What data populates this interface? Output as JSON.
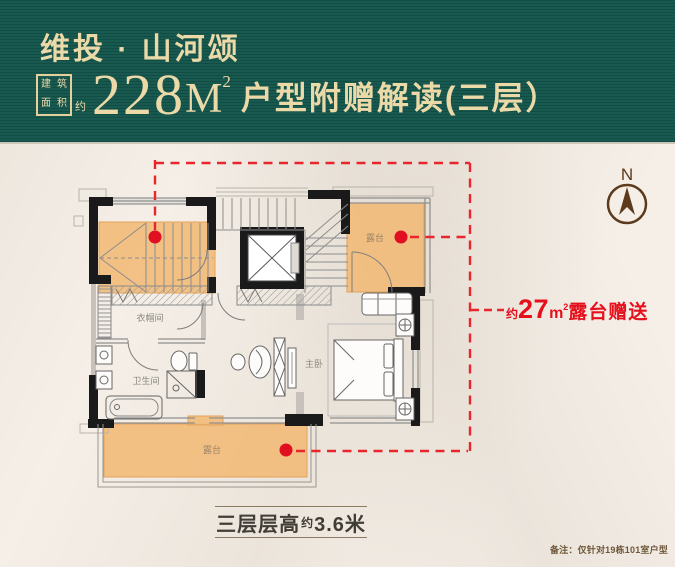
{
  "header": {
    "title": "维投 · 山河颂",
    "seal": {
      "row1a": "建",
      "row1b": "筑",
      "row2a": "面",
      "row2b": "积",
      "approx": "约"
    },
    "area_number": "228",
    "area_unit": "M",
    "area_exponent": "2",
    "subtitle": "户型附赠解读(三层）"
  },
  "plan": {
    "compass_label": "N",
    "rooms": {
      "cloakroom": "衣帽间",
      "bathroom": "卫生间",
      "master_bedroom": "主卧",
      "terrace_right": "露台",
      "terrace_bottom": "露台"
    },
    "annotation": {
      "approx": "约",
      "value": "27",
      "unit": "m",
      "exponent": "2",
      "text": "露台赠送"
    }
  },
  "footer": {
    "floor_main": "三层层高",
    "floor_approx": "约",
    "floor_value": "3.6米",
    "note": "备注：仅针对19栋101室户型"
  },
  "colors": {
    "header_bg": "#14564d",
    "gold": "#ecd9a8",
    "paper": "#f5efe8",
    "terrace_fill": "#f2b976",
    "annotation_red": "#e60f1c",
    "compass_brown": "#5c3a1b",
    "wall_black": "#1a1a1a"
  }
}
